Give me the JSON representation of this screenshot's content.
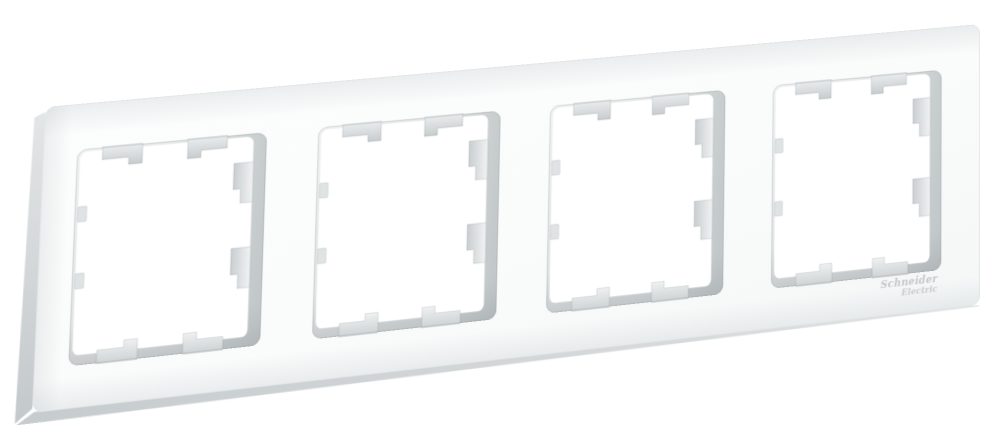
{
  "image": {
    "subject": "White quadruple (4-gang) wall switch frame, photographed at a slight angle on a plain white background",
    "background_color": "#ffffff"
  },
  "brand": {
    "logo_line1": "Schneider",
    "logo_line2": "Electric",
    "logo_color": "#c2c7c9"
  },
  "frame": {
    "gang_count": 4,
    "color_name": "white",
    "face_color": "#fafbfb",
    "inner_wall_color": "#c7cccd",
    "side_face_color": "#ccd1d3",
    "clip_tab_color": "#d3d7d8",
    "window_width": 181,
    "window_height": 210,
    "windows_y": 45,
    "windows_x": [
      32,
      263,
      494,
      725
    ]
  }
}
